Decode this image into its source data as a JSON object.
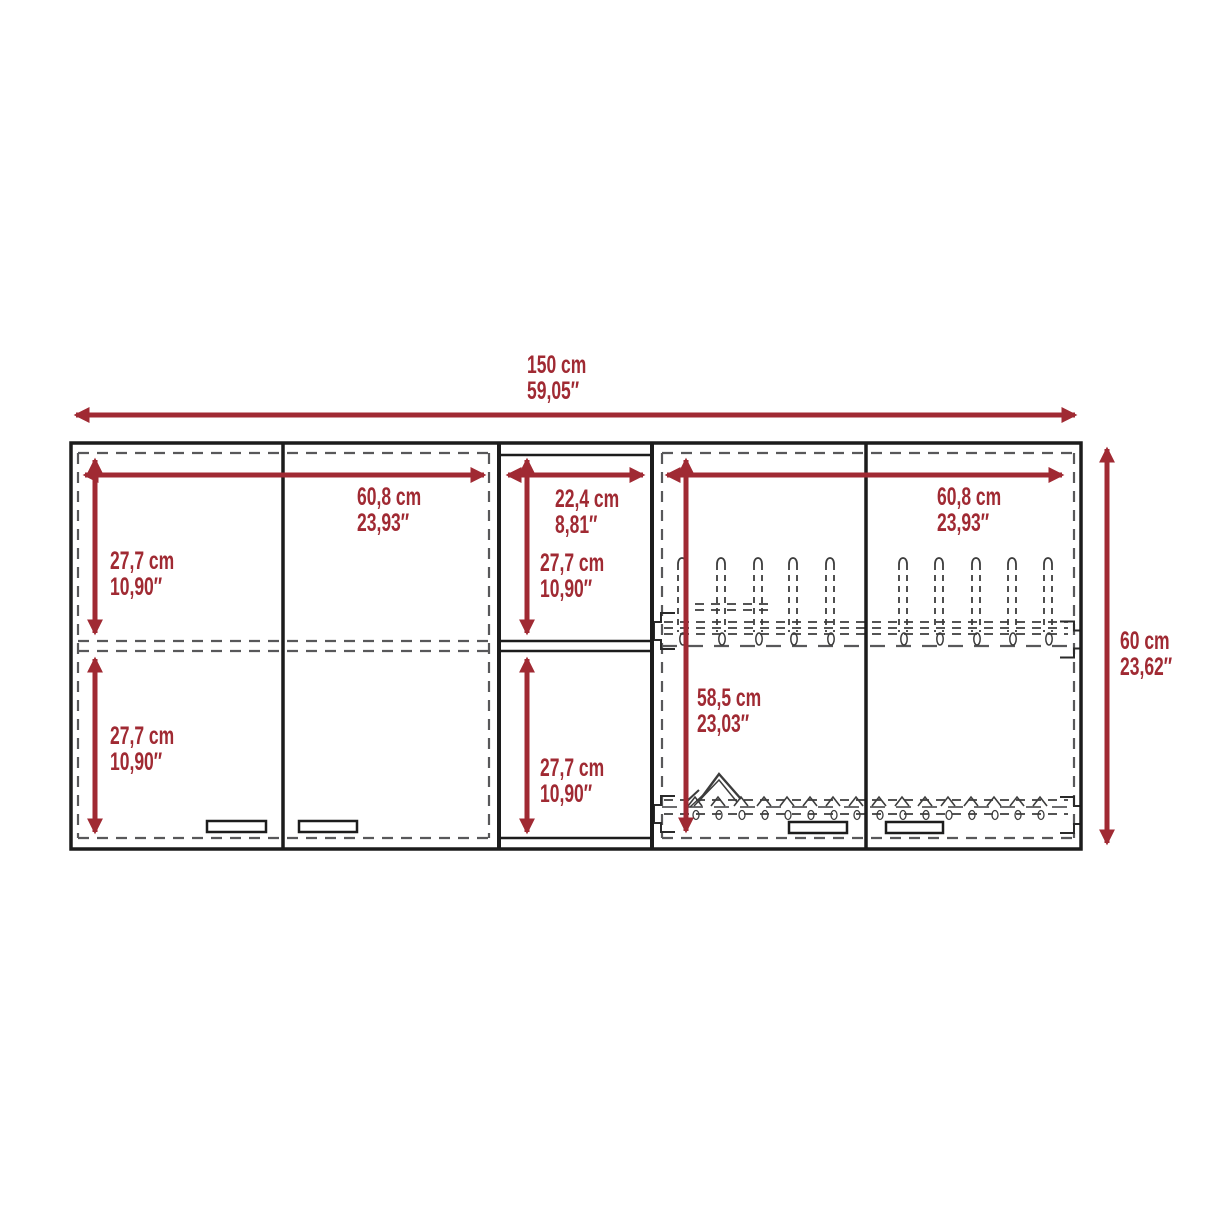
{
  "colors": {
    "accent": "#A02A33",
    "cabinet_line": "#1C1C1C",
    "hidden_line": "#58585A",
    "background": "#FFFFFF"
  },
  "dimensions": {
    "overall_width": {
      "cm": "150 cm",
      "in": "59,05″"
    },
    "overall_height": {
      "cm": "60 cm",
      "in": "23,62″"
    },
    "left_door_width": {
      "cm": "60,8 cm",
      "in": "23,93″"
    },
    "left_top_compartment_height": {
      "cm": "27,7 cm",
      "in": "10,90″"
    },
    "left_bottom_compartment_height": {
      "cm": "27,7 cm",
      "in": "10,90″"
    },
    "center_shelf_width": {
      "cm": "22,4 cm",
      "in": "8,81″"
    },
    "center_top_shelf_height": {
      "cm": "27,7 cm",
      "in": "10,90″"
    },
    "center_bottom_shelf_height": {
      "cm": "27,7 cm",
      "in": "10,90″"
    },
    "right_door_width": {
      "cm": "60,8 cm",
      "in": "23,93″"
    },
    "right_interior_height": {
      "cm": "58,5 cm",
      "in": "23,03″"
    }
  }
}
